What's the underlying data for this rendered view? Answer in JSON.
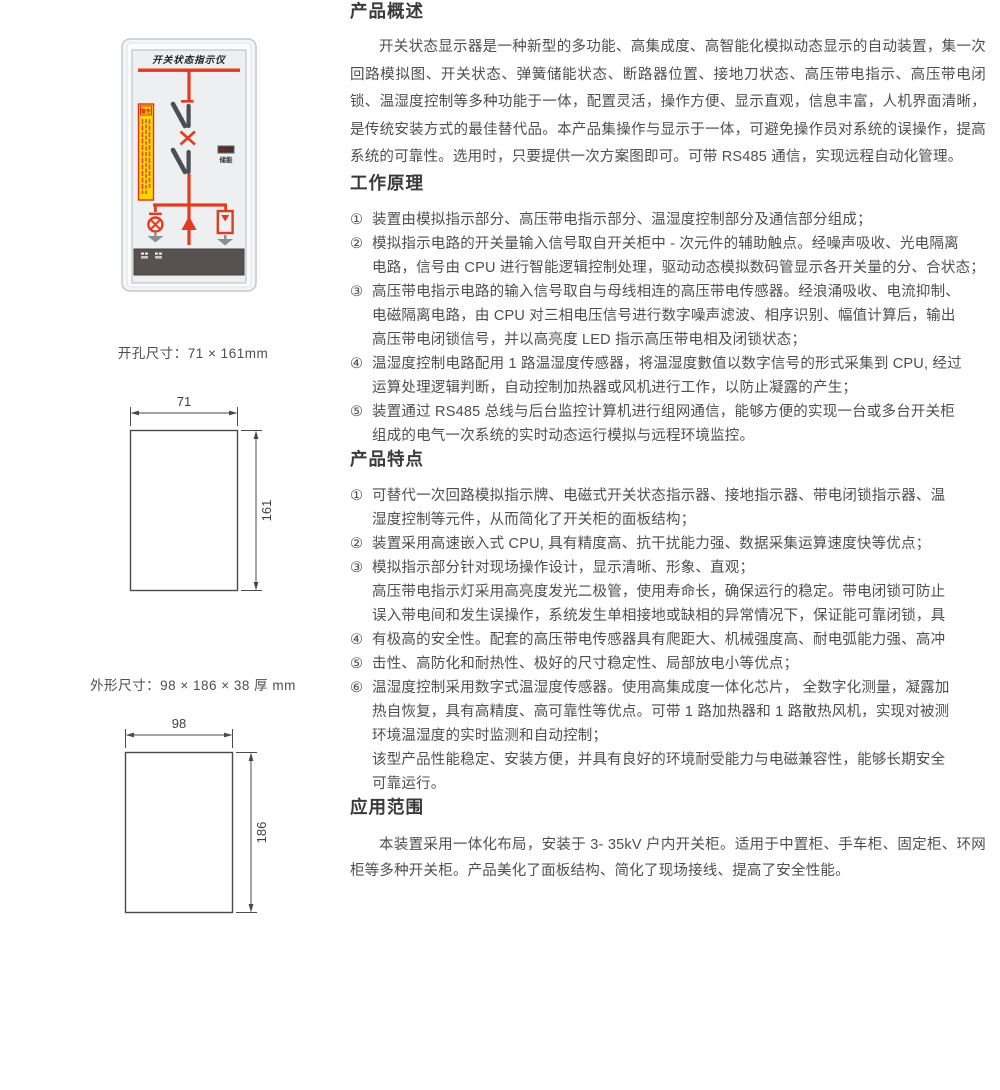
{
  "colors": {
    "diagram_red": "#e23b20",
    "warning_yellow": "#ffd800",
    "blade_gray": "#4b4e55",
    "bottom_panel_dark": "#575150",
    "heading_text": "#3a3a3a",
    "body_text": "#4f4f4f"
  },
  "device": {
    "title": "开关状态指示仪",
    "energy_indicator_label": "储能",
    "warning_label": "警告"
  },
  "dimensions": {
    "cutout": {
      "caption": "开孔尺寸：71 × 161mm",
      "width_value": "71",
      "height_value": "161"
    },
    "overall": {
      "caption": "外形尺寸：98 × 186 × 38 厚 mm",
      "width_value": "98",
      "height_value": "186"
    }
  },
  "sections": {
    "overview": {
      "heading": "产品概述",
      "paragraph": "开关状态显示器是一种新型的多功能、高集成度、高智能化模拟动态显示的自动装置，集一次回路模拟图、开关状态、弹簧储能状态、断路器位置、接地刀状态、高压带电指示、高压带电闭锁、温湿度控制等多种功能于一体，配置灵活，操作方便、显示直观，信息丰富，人机界面清晰，是传统安装方式的最佳替代品。本产品集操作与显示于一体，可避免操作员对系统的误操作，提高系统的可靠性。选用时，只要提供一次方案图即可。可带 RS485 通信，实现远程自动化管理。"
    },
    "principle": {
      "heading": "工作原理",
      "lines": [
        {
          "marker": "①",
          "text": "装置由模拟指示部分、高压带电指示部分、温湿度控制部分及通信部分组成；"
        },
        {
          "marker": "②",
          "text": "模拟指示电路的开关量输入信号取自开关柜中 - 次元件的辅助触点。经噪声吸收、光电隔离"
        },
        {
          "marker": "",
          "text": "电路，信号由 CPU 进行智能逻辑控制处理，驱动动态模拟数码管显示各开关量的分、合状态；"
        },
        {
          "marker": "③",
          "text": "高压带电指示电路的输入信号取自与母线相连的高压带电传感器。经浪涌吸收、电流抑制、"
        },
        {
          "marker": "",
          "text": "电磁隔离电路，由 CPU 对三相电压信号进行数字噪声滤波、相序识别、幅值计算后，输出"
        },
        {
          "marker": "",
          "text": "高压带电闭锁信号，并以高亮度 LED 指示高压带电相及闭锁状态；"
        },
        {
          "marker": "④",
          "text": "温湿度控制电路配用 1 路温湿度传感器，将温湿度數值以数字信号的形式采集到 CPU, 经过"
        },
        {
          "marker": "",
          "text": "运算处理逻辑判断，自动控制加热器或风机进行工作，以防止凝露的产生；"
        },
        {
          "marker": "⑤",
          "text": "装置通过 RS485 总线与后台监控计算机进行组网通信，能够方便的实现一台或多台开关柜"
        },
        {
          "marker": "",
          "text": "组成的电气一次系统的实时动态运行模拟与远程环境监控。"
        }
      ]
    },
    "features": {
      "heading": "产品特点",
      "lines": [
        {
          "marker": "①",
          "text": "可替代一次回路模拟指示牌、电磁式开关状态指示器、接地指示器、带电闭锁指示器、温"
        },
        {
          "marker": "",
          "text": "湿度控制等元件，从而简化了开关柜的面板结构；"
        },
        {
          "marker": "②",
          "text": "装置采用高速嵌入式 CPU, 具有精度高、抗干扰能力强、数据采集运算速度快等优点；"
        },
        {
          "marker": "③",
          "text": "模拟指示部分针对现场操作设计，显示清晰、形象、直观；"
        },
        {
          "marker": "",
          "text": "高压带电指示灯采用高亮度发光二极管，使用寿命长，确保运行的稳定。带电闭锁可防止"
        },
        {
          "marker": "",
          "text": "误入带电间和发生误操作，系统发生单相接地或缺相的异常情况下，保证能可靠闭锁，具"
        },
        {
          "marker": "④",
          "text": "有极高的安全性。配套的高压带电传感器具有爬距大、机械强度高、耐电弧能力强、高冲"
        },
        {
          "marker": "⑤",
          "text": "击性、高防化和耐热性、极好的尺寸稳定性、局部放电小等优点；"
        },
        {
          "marker": "⑥",
          "text": "温湿度控制采用数字式温湿度传感器。使用高集成度一体化芯片， 全数字化测量，凝露加"
        },
        {
          "marker": "",
          "text": "热自恢复，具有高精度、高可靠性等优点。可带 1 路加热器和 1 路散热风机，实现对被测"
        },
        {
          "marker": "",
          "text": "环境温湿度的实时监测和自动控制；"
        },
        {
          "marker": "",
          "text": "该型产品性能稳定、安装方便，并具有良好的环境耐受能力与电磁兼容性，能够长期安全"
        },
        {
          "marker": "",
          "text": "可靠运行。"
        }
      ]
    },
    "application": {
      "heading": "应用范围",
      "paragraph": "本装置采用一体化布局，安装于 3- 35kV 户内开关柜。适用于中置柜、手车柜、固定柜、环网柜等多种开关柜。产品美化了面板结构、简化了现场接线、提高了安全性能。"
    }
  }
}
